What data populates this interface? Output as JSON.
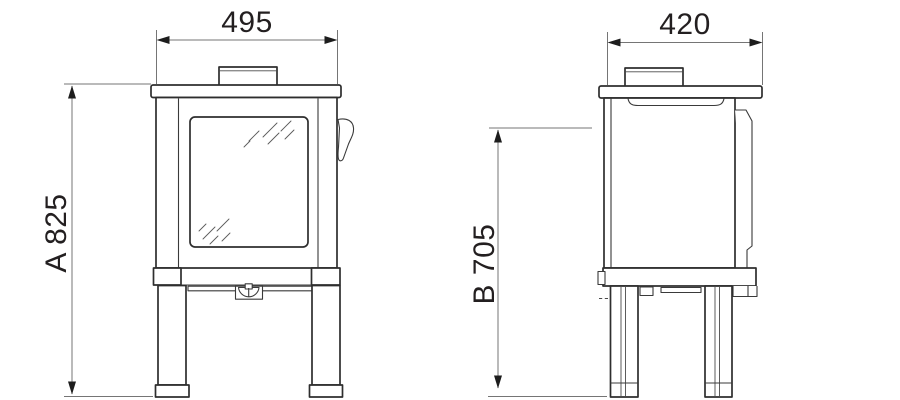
{
  "drawing": {
    "kind": "stove-dimension-diagram",
    "views": {
      "front": "front-elevation",
      "side": "side-elevation"
    },
    "dimensions": {
      "front_width": {
        "label": "495"
      },
      "side_depth": {
        "label": "420"
      },
      "overall_height": {
        "label": "A 825"
      },
      "secondary_height": {
        "label": "B 705"
      }
    },
    "colors": {
      "outline": "#2e2e2e",
      "dimension_line": "#757575",
      "arrowhead": "#1d1d1d",
      "label_text": "#231f20",
      "background": "#ffffff"
    }
  }
}
